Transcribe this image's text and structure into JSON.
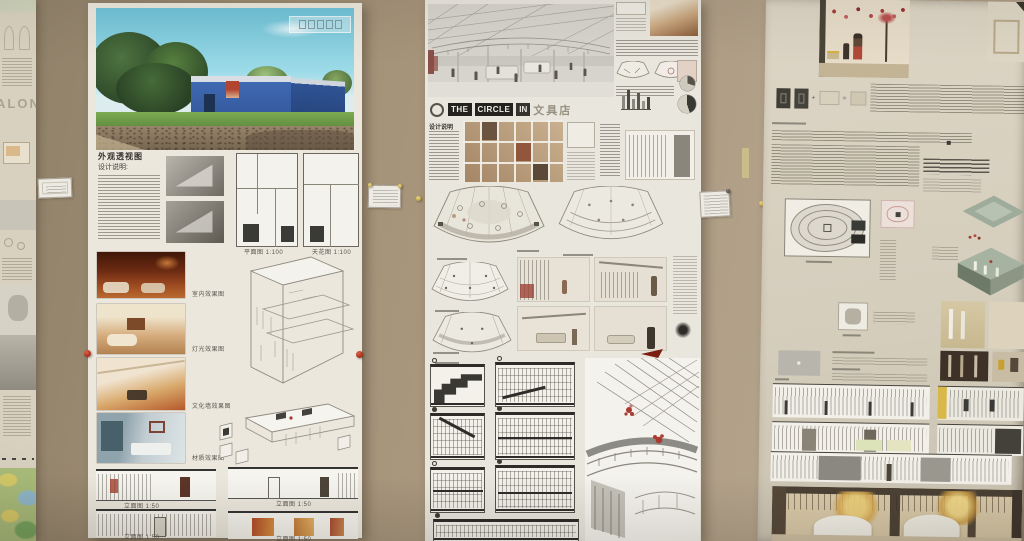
{
  "scene": {
    "wall_color": "#a6947e",
    "accents": {
      "red_pin": "#c23a28",
      "yellow_pin": "#d4b84a",
      "dark_pin": "#55504a",
      "tape": "#cfc489"
    }
  },
  "left_edge_poster": {
    "watermark": "ALON"
  },
  "poster1": {
    "heading": "外观透视图",
    "subheading": "设计说明:",
    "plan_captions": [
      "平面图 1:100",
      "天花图 1:100"
    ],
    "photo_captions": [
      "室内效果图",
      "灯光效果图",
      "文化墙效果图",
      "材质效果图"
    ],
    "elevation_captions": [
      "立面图 1:50",
      "立面图 1:50",
      "立面图 1:50",
      "立面图 1:50"
    ],
    "render_colors": {
      "sky": "#74c6da",
      "building": "#3f69b2",
      "grass": "#76a24e",
      "tree": "#2b4628"
    }
  },
  "poster2": {
    "title_words": [
      "THE",
      "CIRCLE",
      "IN"
    ],
    "title_suffix": "文具店",
    "note_heading": "设计说明"
  },
  "poster3": {
    "accent_colors": {
      "blossom_red": "#a83c3c",
      "blossom_gold": "#d8a850",
      "elevation_yellow": "#d8b848"
    }
  }
}
